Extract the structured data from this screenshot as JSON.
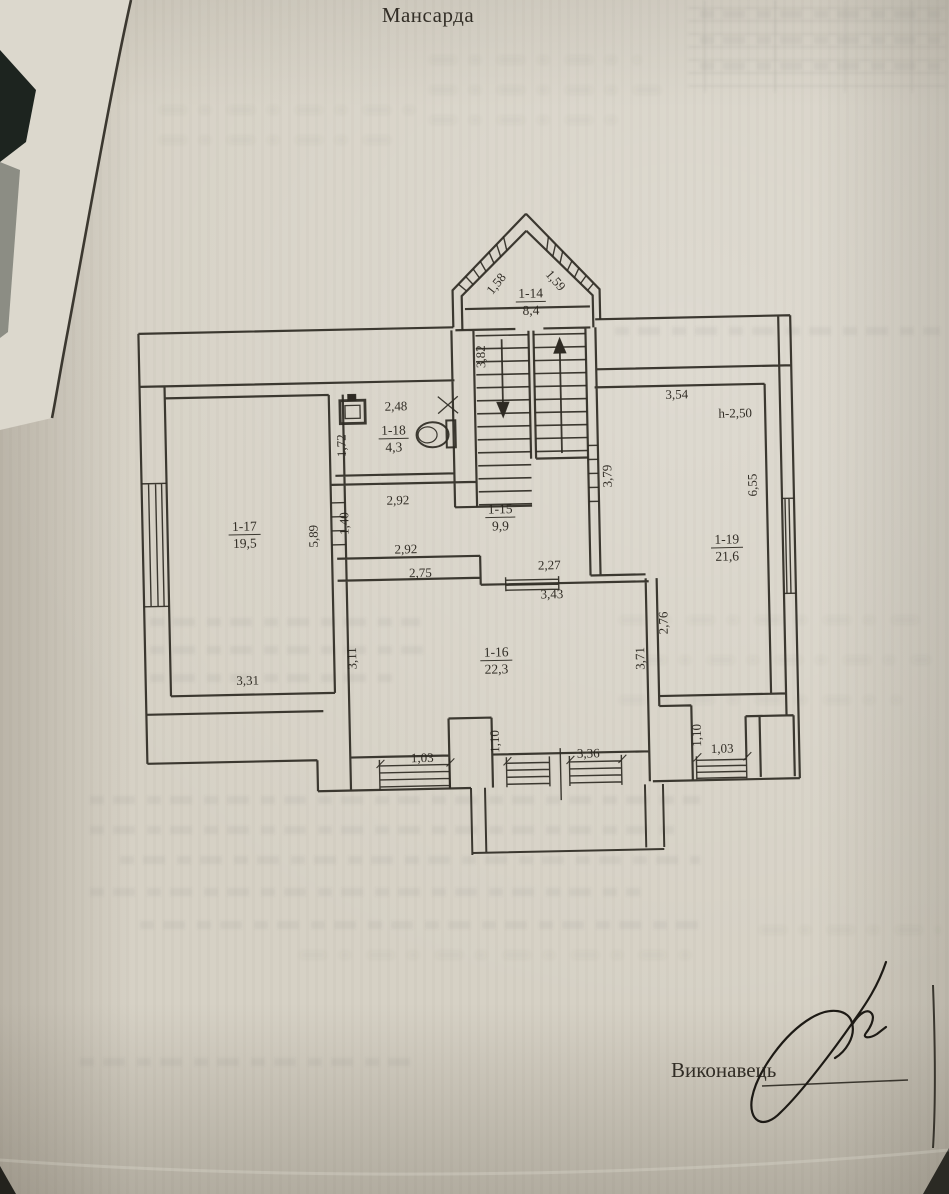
{
  "page": {
    "title": "Мансарда",
    "executor_label": "Виконавець"
  },
  "plan": {
    "rooms": {
      "r14": {
        "id": "1-14",
        "area": "8,4"
      },
      "r15": {
        "id": "1-15",
        "area": "9,9"
      },
      "r16": {
        "id": "1-16",
        "area": "22,3"
      },
      "r17": {
        "id": "1-17",
        "area": "19,5"
      },
      "r18": {
        "id": "1-18",
        "area": "4,3"
      },
      "r19": {
        "id": "1-19",
        "area": "21,6"
      }
    },
    "dims": {
      "bay_window_left": "1,58",
      "bay_window_right": "1,59",
      "stair_flight": "3,82",
      "wc_width": "2,48",
      "wc_depth": "1,72",
      "hall_width_top": "2,92",
      "hall_door": "1,40",
      "r17_inner_wall": "5,89",
      "hall_width_bottom": "2,92",
      "step_width": "2,75",
      "hall_window": "2,27",
      "r16_width_top": "3,43",
      "r19_width_top": "3,54",
      "r19_height_note": "h-2,50",
      "r19_door_wall": "3,79",
      "r19_depth_right": "6,55",
      "r16_depth_left": "3,11",
      "r17_width_bottom": "3,31",
      "r19_depth_low": "2,76",
      "r16_depth_right": "3,71",
      "window_left": "1,03",
      "pier_left": "1,10",
      "window_center": "3,36",
      "pier_right": "1,10",
      "window_right": "1,03"
    }
  }
}
